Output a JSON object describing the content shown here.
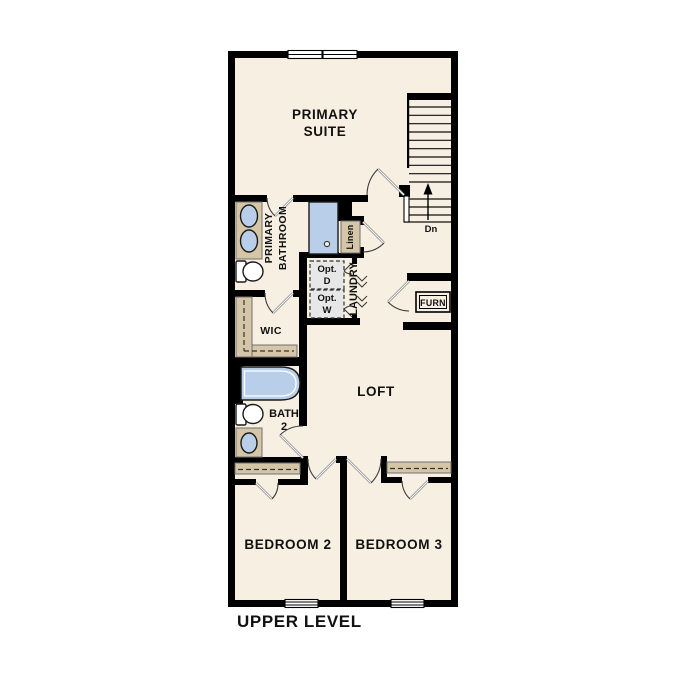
{
  "level_label": "UPPER LEVEL",
  "rooms": {
    "primary_suite_line1": "PRIMARY",
    "primary_suite_line2": "SUITE",
    "primary_bath_line1": "PRIMARY",
    "primary_bath_line2": "BATHROOM",
    "wic": "WIC",
    "linen": "Linen",
    "laundry": "LAUNDRY",
    "loft": "LOFT",
    "bath2_line1": "BATH",
    "bath2_line2": "2",
    "bedroom2": "BEDROOM 2",
    "bedroom3": "BEDROOM 3"
  },
  "features": {
    "furnace": "FURN",
    "stairs_direction": "Dn",
    "optional_dryer_line1": "Opt.",
    "optional_dryer_line2": "D",
    "optional_washer_line1": "Opt.",
    "optional_washer_line2": "W"
  },
  "colors": {
    "background": "#ffffff",
    "floor": "#f7efe1",
    "wall": "#000000",
    "shelf_tan": "#d5c6a8",
    "shelf_border": "#707070",
    "fixture_blue": "#b9cfe9",
    "fixture_outline": "#1a1a1a",
    "appliance_gray": "#e7e7e7",
    "door_leaf_gray": "#8a8a8a",
    "arc_gray": "#3c3c3c",
    "dashed_rod": "#333333",
    "text": "#111111"
  }
}
